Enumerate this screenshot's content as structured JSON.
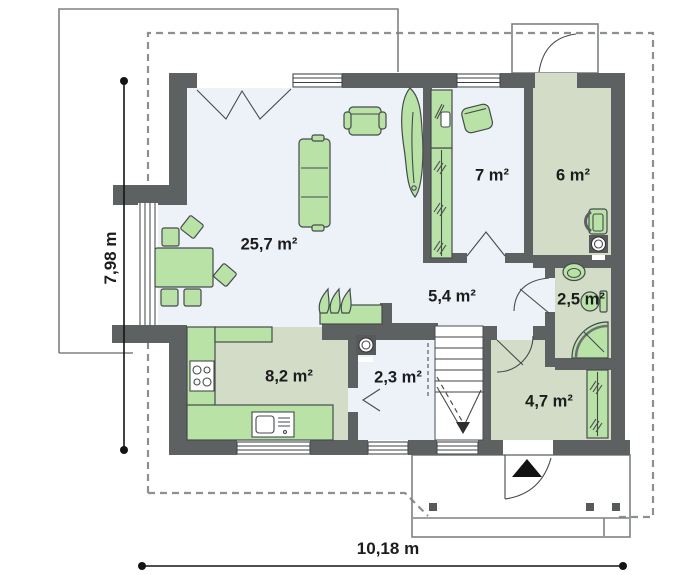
{
  "plan_title": "house-ground-floor-plan",
  "rooms": [
    {
      "name": "living-room",
      "area_label": "25,7 m²"
    },
    {
      "name": "room-7",
      "area_label": "7 m²"
    },
    {
      "name": "utility-room-6",
      "area_label": "6 m²"
    },
    {
      "name": "hall",
      "area_label": "5,4 m²"
    },
    {
      "name": "bathroom",
      "area_label": "2,5 m²"
    },
    {
      "name": "kitchen",
      "area_label": "8,2 m²"
    },
    {
      "name": "wc-laundry",
      "area_label": "2,3 m²"
    },
    {
      "name": "entrance-hall",
      "area_label": "4,7 m²"
    }
  ],
  "dimensions": {
    "height_label": "7,98 m",
    "width_label": "10,18 m"
  },
  "icons": [
    {
      "name": "sofa-icon",
      "shape": "svg"
    },
    {
      "name": "armchair-icon",
      "shape": "svg"
    },
    {
      "name": "dining-table-icon",
      "shape": "svg"
    },
    {
      "name": "plant-icon",
      "shape": "svg"
    },
    {
      "name": "fireplace-icon",
      "shape": "svg"
    },
    {
      "name": "stove-icon",
      "shape": "svg"
    },
    {
      "name": "kitchen-sink-icon",
      "shape": "svg"
    },
    {
      "name": "washing-machine-icon",
      "shape": "svg"
    },
    {
      "name": "boiler-icon",
      "shape": "svg"
    },
    {
      "name": "washbasin-icon",
      "shape": "svg"
    },
    {
      "name": "toilet-icon",
      "shape": "svg"
    },
    {
      "name": "shower-icon",
      "shape": "svg"
    },
    {
      "name": "wardrobe-icon",
      "shape": "svg"
    },
    {
      "name": "stairs-icon",
      "shape": "svg"
    },
    {
      "name": "entrance-arrow-icon",
      "shape": "triangle"
    }
  ],
  "colors": {
    "wall": "#5e6161",
    "floor_light": "#edf1f8",
    "floor_green": "#d2dcc7",
    "furniture_green": "#b9e3a6",
    "furniture_outline": "#454a4d",
    "porch_outline": "#7d8284",
    "dash_line": "#8d9092",
    "dimension": "#141414"
  }
}
